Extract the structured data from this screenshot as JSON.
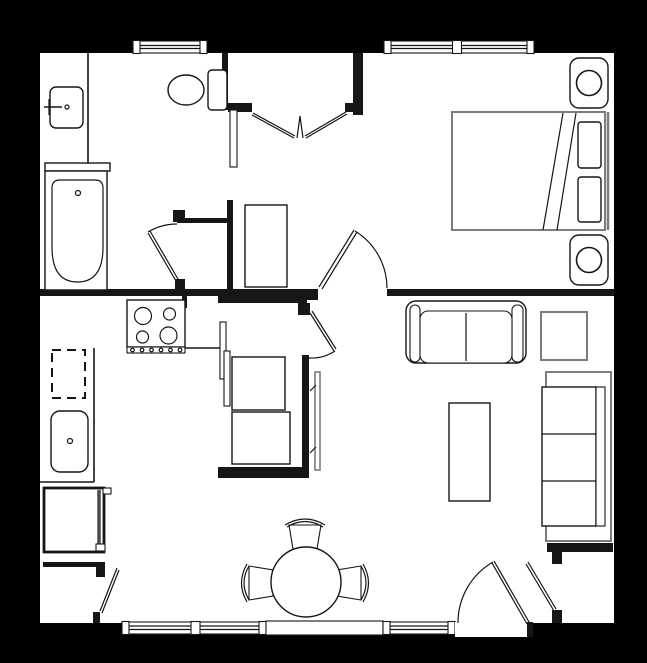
{
  "meta": {
    "title": "One-bedroom apartment floor plan",
    "document_type": "architectural floor plan drawing",
    "has_visible_text": false
  },
  "colors": {
    "background": "#000000",
    "floor": "#ffffff",
    "walls": "#161616",
    "furniture_accent": "#7d7d7d",
    "appliance_dark": "#4a4a4a"
  },
  "rooms": [
    {
      "name": "bathroom",
      "fixtures": [
        "vanity-counter",
        "sink-with-faucet",
        "toilet",
        "bathtub",
        "swing-door"
      ]
    },
    {
      "name": "bedroom-closet",
      "fixtures": [
        "bifold-doors"
      ]
    },
    {
      "name": "bedroom",
      "fixtures": [
        "double-bed",
        "pillow",
        "pillow",
        "nightstand-with-lamp",
        "nightstand-with-lamp",
        "swing-door",
        "window"
      ]
    },
    {
      "name": "kitchen",
      "fixtures": [
        "range-cooktop-4-burners",
        "control-knobs",
        "dishwasher-dashed",
        "kitchen-sink",
        "refrigerator",
        "counter-edge"
      ]
    },
    {
      "name": "laundry-closet",
      "fixtures": [
        "washer",
        "dryer",
        "sliding-door-panels",
        "swing-door",
        "tv-panel"
      ]
    },
    {
      "name": "hallway",
      "fixtures": [
        "storage-shelf"
      ]
    },
    {
      "name": "dining-area",
      "fixtures": [
        "round-table",
        "chair",
        "chair",
        "chair",
        "window",
        "fixed-panel"
      ]
    },
    {
      "name": "living-room",
      "fixtures": [
        "loveseat",
        "side-table",
        "coffee-table",
        "sofa",
        "window"
      ]
    },
    {
      "name": "entry",
      "fixtures": [
        "entry-swing-door",
        "coat-closet-door",
        "storage-closet-door"
      ]
    }
  ],
  "window_count": 5,
  "door_count": 8
}
